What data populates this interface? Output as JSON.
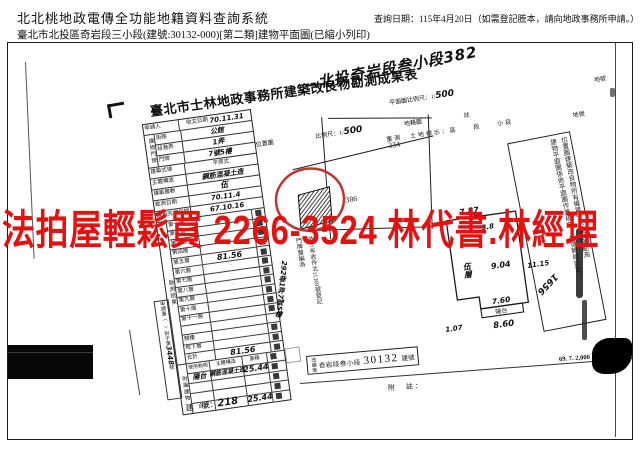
{
  "header": {
    "system_title": "北北桃地政電傳全功能地籍資料查詢系統",
    "query_date": "查詢日期：115年4月20日（如需登記謄本，請向地政事務所申請。）",
    "subtitle": "臺北市北投區奇岩段三小段(建號:30132-000)[第二類]建物平面圖(已縮小列印)"
  },
  "watermark": {
    "text": "法拍屋輕鬆買 2266-3524 林代書.林經理",
    "color": "#e41111"
  },
  "doc": {
    "title": "臺北市士林地政事務所建築改良物勘測成果表",
    "site_handwritten": "北投奇岩段叁小段382",
    "parcel_no_label_top": "地號",
    "scale_top_label": "平面圖比例尺：1/",
    "scale_top_value": "500",
    "map_header": {
      "t1": "位置圖",
      "t2": "比例尺：1/",
      "hand": "500",
      "t3": "地籍圖",
      "t4": "註"
    },
    "map": {
      "parcel_a": "334",
      "parcel_b": "386"
    },
    "resurvey": {
      "label": "重測　土地標示：",
      "cols": "區　　段　　小段",
      "parcel_label": "地號"
    },
    "table": {
      "applicant": "申請人",
      "received": "收文日期",
      "received_hand": "70.11.31",
      "address_label": "建物門牌",
      "addr": [
        {
          "l": "街路",
          "v": "公館"
        },
        {
          "l": "段巷弄",
          "v": "1弄"
        },
        {
          "l": "門牌",
          "v": "7號5樓"
        }
      ],
      "style_l": "建築式樣",
      "style_v": "平房式",
      "struct_l": "主體構造",
      "struct_v": "鋼筋混凝土造",
      "floors_l": "建築層數",
      "floors_v": "伍",
      "survey_l": "勘測日期",
      "survey_v": "70.11.4",
      "complete_l": "建築完成日期",
      "complete_v": "67.10.16",
      "result_label": "勘測結果",
      "floors": [
        {
          "l": "第一層",
          "v": "·"
        },
        {
          "l": "第二層",
          "v": "·"
        },
        {
          "l": "第三層",
          "v": "·"
        },
        {
          "l": "第四層",
          "v": "·"
        },
        {
          "l": "第五層",
          "v": "81.56"
        },
        {
          "l": "第六層",
          "v": "·"
        },
        {
          "l": "第七層",
          "v": "·"
        },
        {
          "l": "第八層",
          "v": "·"
        },
        {
          "l": "第九層",
          "v": "·"
        },
        {
          "l": "第十層",
          "v": "·"
        },
        {
          "l": "第十一層",
          "v": "·"
        },
        {
          "l": "",
          "v": ""
        },
        {
          "l": "騎樓",
          "v": "·"
        },
        {
          "l": "地下層",
          "v": "·"
        },
        {
          "l": "合計",
          "v": "81.56"
        }
      ],
      "attach_label": "附屬建物",
      "attach_head": {
        "c1": "使用執照",
        "c2": "主體構造",
        "c3": "面積"
      },
      "attach_rows": [
        {
          "c1": "陽台",
          "c2": "鋼筋混凝土造",
          "c3": "25.44"
        },
        {
          "c1": "",
          "c2": "",
          "c3": "·"
        },
        {
          "c1": "",
          "c2": "",
          "c3": "·"
        },
        {
          "c1": "合計",
          "c2": "",
          "c3": "25.44"
        }
      ],
      "appbook": "申請書（　）附于第",
      "appbook_no": "3448",
      "appbook_suffix": "號"
    },
    "door_stamp": {
      "l1": "依97年收件北11369號登記",
      "l2": "門牌整編為",
      "hand": "292巷1弄7號5樓"
    },
    "plan": {
      "top": "7.87",
      "top_inner": "3.8",
      "floor": "伍層",
      "mid": "9.04",
      "right": "11.15",
      "bottom_inner": "7.60",
      "balcony": "陽台",
      "bottom": "8.60",
      "left": "1.07"
    },
    "note_box": {
      "right_col": "位置圖建築改良物所有權第一次登記僅勘測",
      "left_col": "建物平面圖係依平面圖作業規定。本號轉繪計算。",
      "hand": "1656"
    },
    "restamp": {
      "prefix": "改編後",
      "body": "奇岩段叁小段",
      "num": "30132",
      "suffix": "建號"
    },
    "footnote": "附　註：",
    "print_code": "69. 7. 2,000",
    "building_no": {
      "label": "建　號：",
      "value": "218"
    }
  }
}
